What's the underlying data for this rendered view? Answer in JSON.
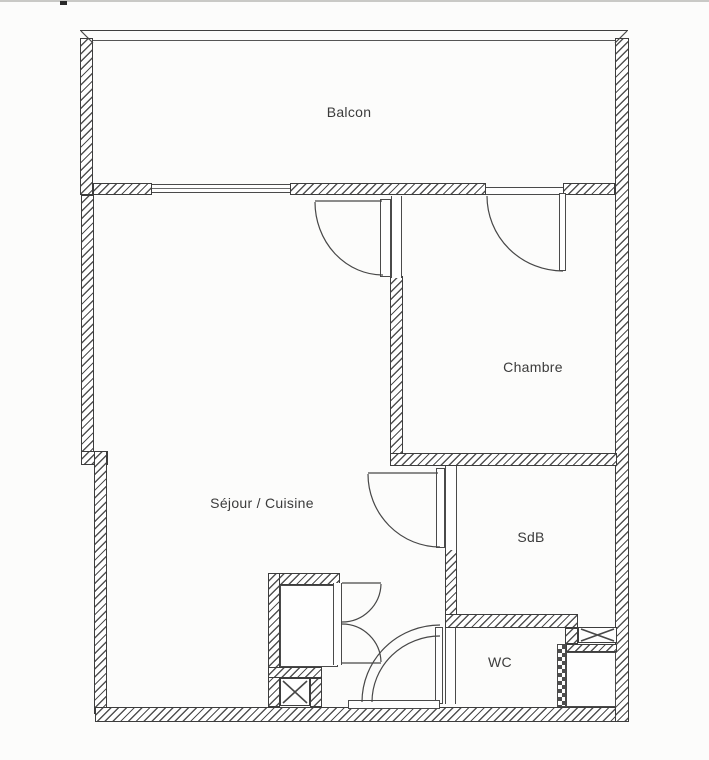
{
  "floorplan": {
    "type": "apartment-floor-plan",
    "rooms": [
      {
        "name": "balcon",
        "label": "Balcon"
      },
      {
        "name": "chambre",
        "label": "Chambre"
      },
      {
        "name": "sejour-cuisine",
        "label": "Séjour / Cuisine"
      },
      {
        "name": "salle-de-bain",
        "label": "SdB"
      },
      {
        "name": "wc",
        "label": "WC"
      }
    ],
    "colors": {
      "background": "#fcfcfb",
      "line": "#3d3d3d",
      "hatch": "#525252",
      "text": "#3b3b3b"
    }
  }
}
